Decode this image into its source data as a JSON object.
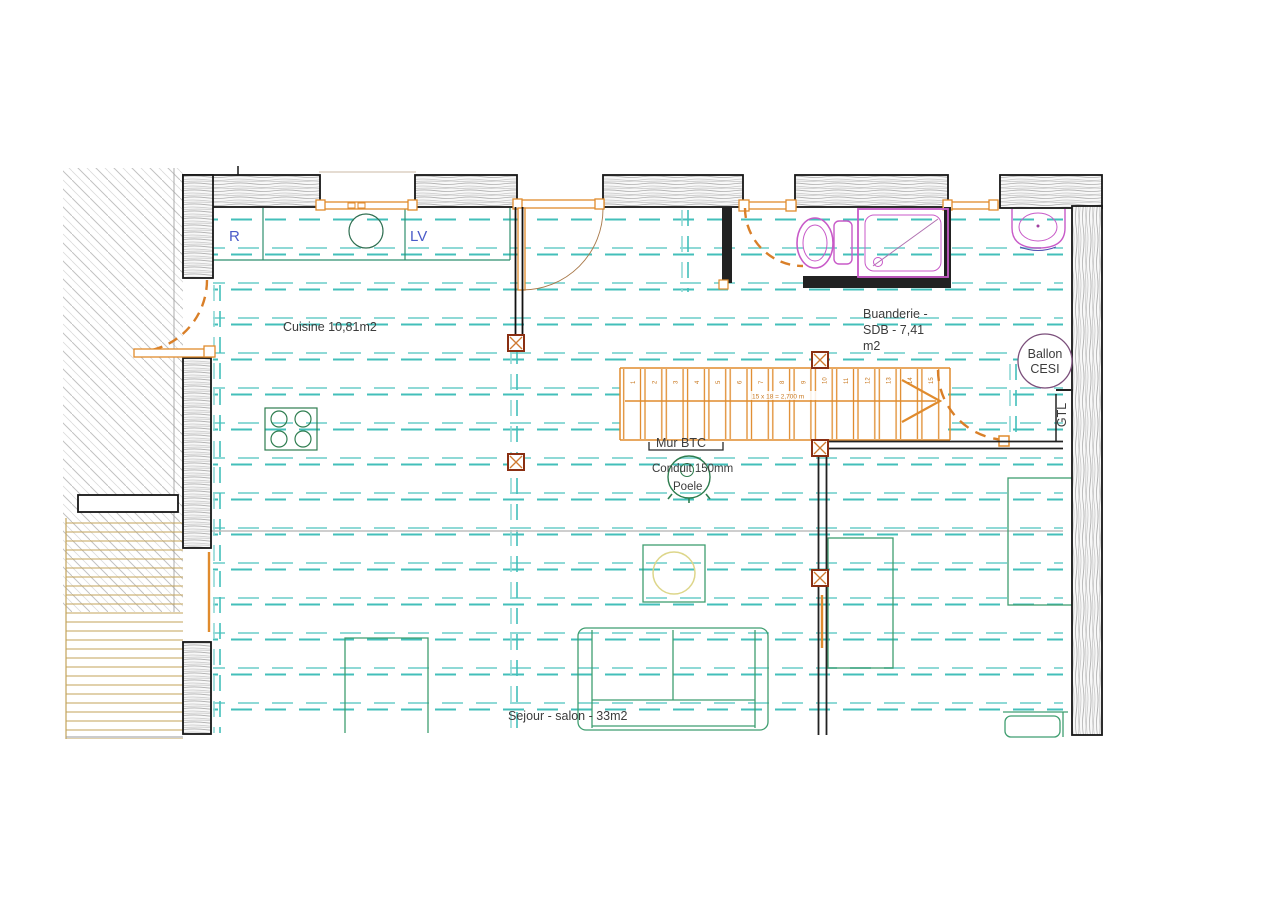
{
  "drawing": {
    "rooms": {
      "cuisine": "Cuisine 10,81m2",
      "buanderie_line1": "Buanderie -",
      "buanderie_line2": "SDB - 7,41",
      "buanderie_line3": "m2",
      "sejour": "Sejour - salon - 33m2"
    },
    "appliances": {
      "fridge": "R",
      "dishwasher": "LV"
    },
    "equipment": {
      "ballon_line1": "Ballon",
      "ballon_line2": "CESI",
      "gtl": "GTL",
      "mur_btc": "Mur BTC",
      "conduit": "Conduit 150mm",
      "poele": "Poele"
    },
    "stairs": {
      "note": "15 x 18 = 2,700 m",
      "tread_numbers": [
        "1",
        "2",
        "3",
        "4",
        "5",
        "6",
        "7",
        "8",
        "9",
        "10",
        "11",
        "12",
        "13",
        "14",
        "15"
      ]
    },
    "colors": {
      "heating_light": "#8fd9d6",
      "heating_dark": "#43bfba",
      "timber_orange": "#e08b2d",
      "fixture_magenta": "#c85ac8",
      "furniture_green": "#3f9e70",
      "label_blue": "#4a5ac8",
      "post_red": "#8a2f12",
      "text": "#3c3c3c"
    }
  }
}
